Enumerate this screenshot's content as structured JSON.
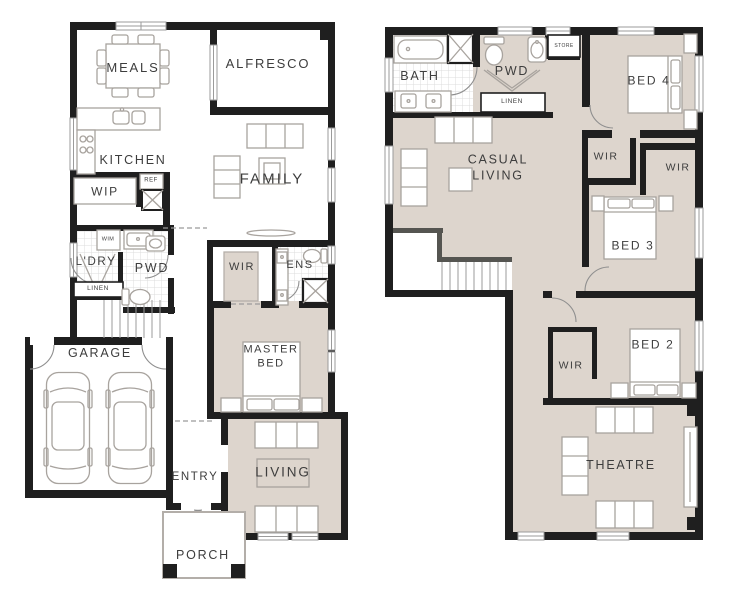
{
  "colors": {
    "wall": "#1f1f1f",
    "stair_wall": "#555551",
    "room_fill": "#ddd5cd",
    "furniture_line": "#a8a39e",
    "window_line": "#9b9b9b",
    "tile_line": "#dcdcdc",
    "text": "#3d3d3d"
  },
  "ground_floor": {
    "rooms": {
      "meals": "MEALS",
      "alfresco": "ALFRESCO",
      "kitchen": "KITCHEN",
      "family": "FAMILY",
      "wip": "WIP",
      "ref": "REF",
      "wim": "WIM",
      "ldry": "L'DRY",
      "pwd": "PWD",
      "linen": "LINEN",
      "wir": "WIR",
      "ens": "ENS",
      "master_bed": "MASTER BED",
      "garage": "GARAGE",
      "entry": "ENTRY",
      "living": "LIVING",
      "porch": "PORCH"
    }
  },
  "first_floor": {
    "rooms": {
      "bath": "BATH",
      "pwd": "PWD",
      "store": "STORE",
      "linen": "LINEN",
      "bed4": "BED 4",
      "casual_living": "CASUAL LIVING",
      "wir_bed4": "WIR",
      "wir_bed3": "WIR",
      "bed3": "BED 3",
      "bed2": "BED 2",
      "wir_bed2": "WIR",
      "theatre": "THEATRE"
    }
  }
}
